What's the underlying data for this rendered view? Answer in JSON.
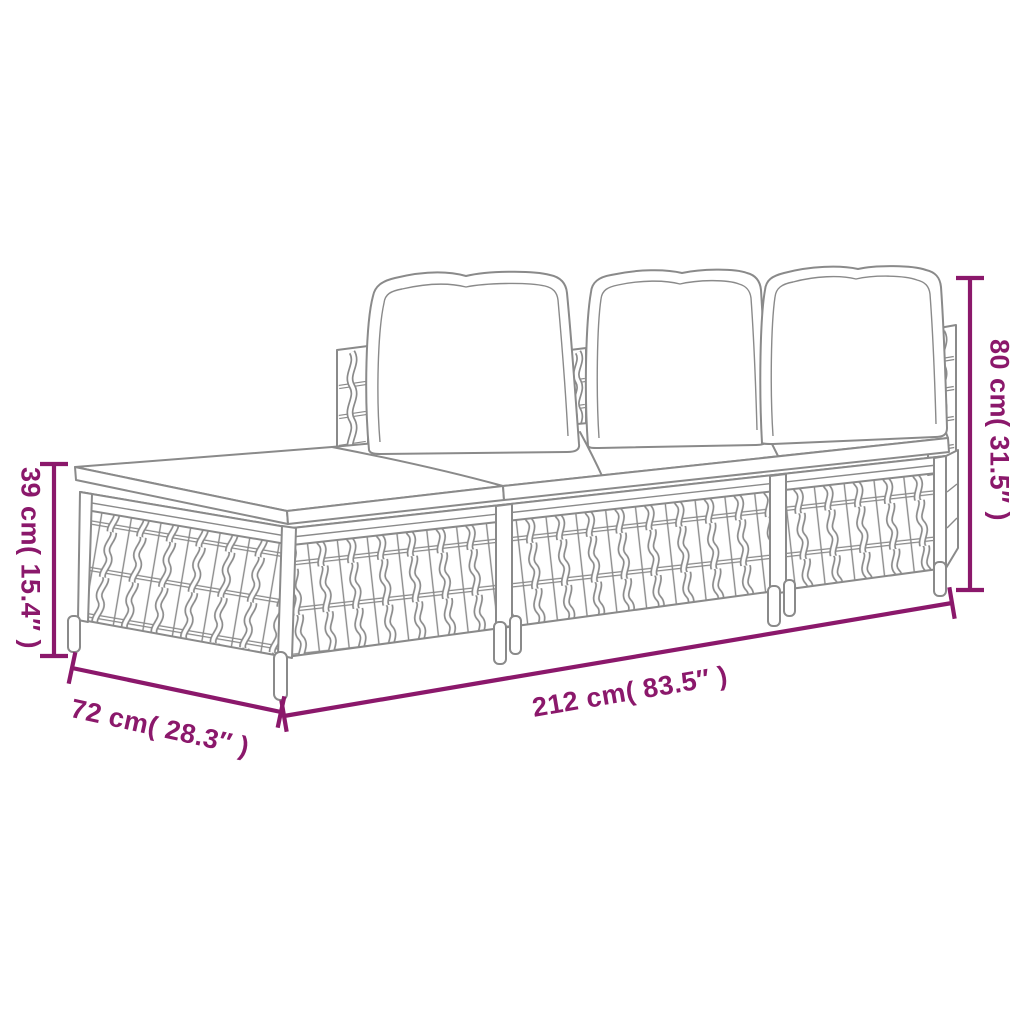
{
  "diagram": {
    "type": "product-dimension-diagram",
    "subject": "3-piece poly rattan garden lounge set with cushions",
    "colors": {
      "accent": "#8B186B",
      "line": "#8A8A8A",
      "bg": "#FFFFFF"
    },
    "dimensions": {
      "height": {
        "label": "80 cm( 31.5″ )",
        "cm": 80,
        "inches": 31.5
      },
      "seat_height": {
        "label": "39 cm( 15.4″ )",
        "cm": 39,
        "inches": 15.4
      },
      "length": {
        "label": "212 cm( 83.5″ )",
        "cm": 212,
        "inches": 83.5
      },
      "depth": {
        "label": "72 cm( 28.3″ )",
        "cm": 72,
        "inches": 28.3
      }
    }
  }
}
